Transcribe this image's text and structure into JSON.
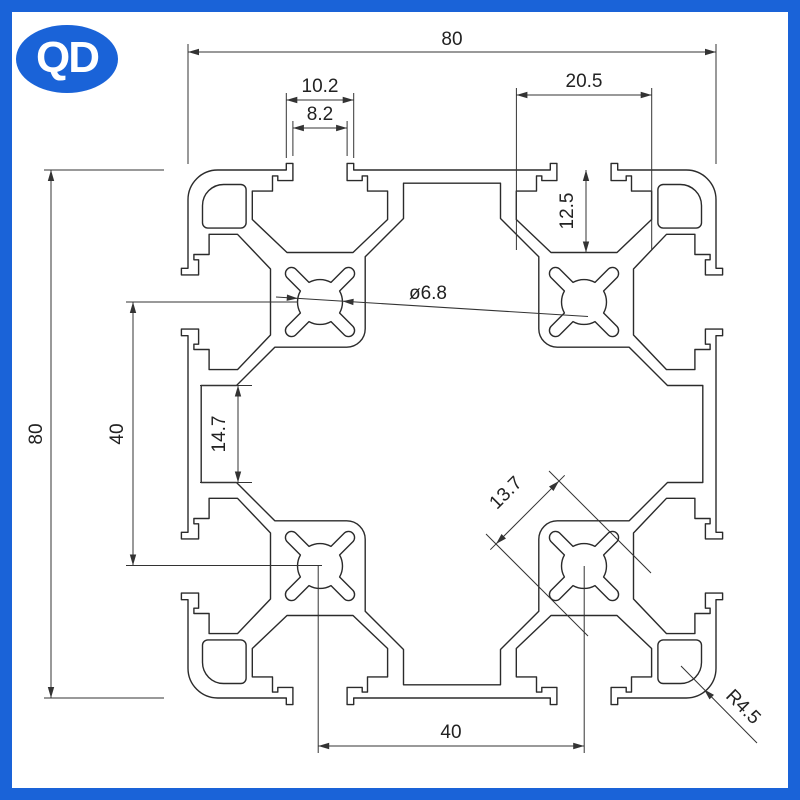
{
  "logo": {
    "text": "QD"
  },
  "colors": {
    "frame": "#1a63d8",
    "line": "#2b2b2b",
    "background": "#ffffff"
  },
  "dimensions": {
    "overall_width": "80",
    "overall_height": "80",
    "slot_rim_width": "10.2",
    "slot_opening_width": "8.2",
    "slot_chamber_width": "20.5",
    "slot_depth": "12.5",
    "center_hole_diameter": "ø6.8",
    "boss_spacing_vertical": "40",
    "side_pocket_height": "14.7",
    "boss_block_diagonal": "13.7",
    "boss_spacing_horizontal": "40",
    "corner_radius": "R4.5"
  }
}
